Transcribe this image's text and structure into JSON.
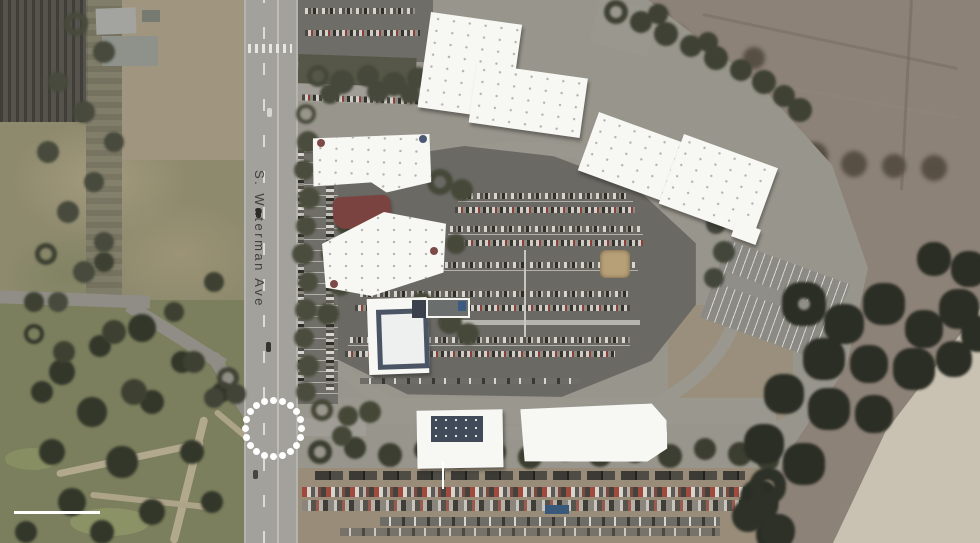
{
  "figure": {
    "type": "aerial-site-map",
    "road_label": "S. Waterman Ave",
    "annotations": {
      "intersection_highlight": "white dotted circle marking the road intersection",
      "building_leader_line": "white vertical leader line below lower-left building",
      "scale_bar": "white horizontal scale bar, lower-left corner"
    },
    "colors": {
      "annotation_white": "#ffffff",
      "building_roof": "#f7f7f3",
      "pavilion_roof": "#7b4340",
      "slate_roof": "#404a58",
      "asphalt_parking": "#6b6964",
      "street": "#a3a19c",
      "campus_ground": "#98958c",
      "field_left": "#8e8a6e",
      "golf_course": "#7b7f5d",
      "dirt_right": "#8d8278",
      "sand_wash": "#c9c1b1",
      "trees_dark": "#2b2e25"
    }
  }
}
